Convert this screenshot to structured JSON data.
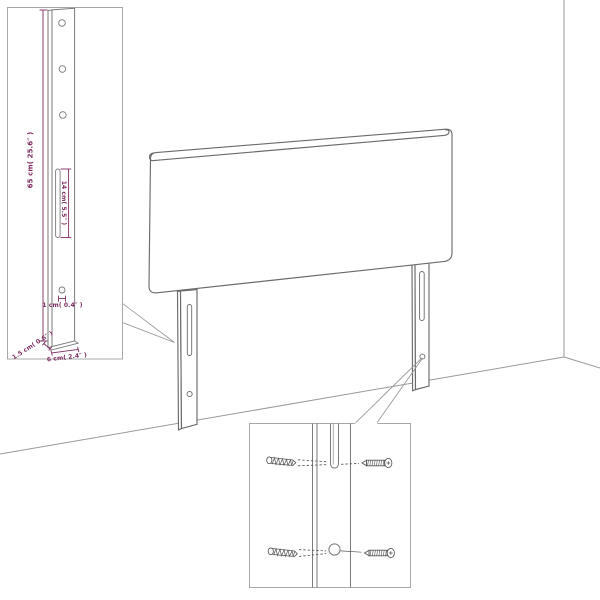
{
  "labels": {
    "post_height": "65 cm( 25.6″ )",
    "slot_length": "14 cm( 5.5″ )",
    "hole_size": "1 cm( 0.4″ )",
    "post_thickness": "1.5 cm( 0.6″ )",
    "post_width": "6 cm( 2.4″ )"
  },
  "colors": {
    "background": "#ffffff",
    "outline": "#6b6b6b",
    "part_line": "#7a7a7a",
    "room_line": "#9a9a9a",
    "inset_border": "#a8a8a8",
    "hardware": "#555555",
    "dimension": "#7d2b5f"
  }
}
